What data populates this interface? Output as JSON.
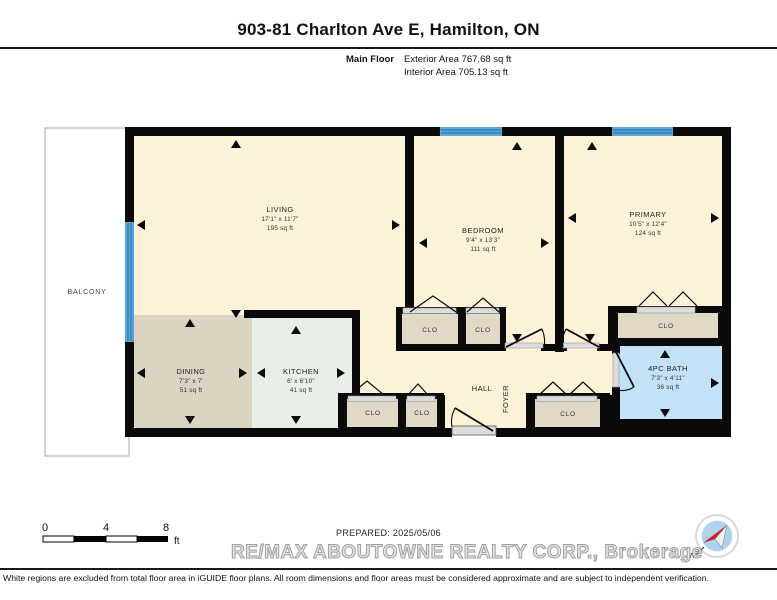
{
  "header": {
    "title": "903-81 Charlton Ave E, Hamilton, ON",
    "floor_label": "Main Floor",
    "exterior_area": "Exterior Area 767.68 sq ft",
    "interior_area": "Interior Area 705.13 sq ft"
  },
  "rooms": {
    "living": {
      "name": "LIVING",
      "dims": "17'1\" x 11'7\"",
      "area": "195 sq ft"
    },
    "bedroom": {
      "name": "BEDROOM",
      "dims": "9'4\" x 13'3\"",
      "area": "111 sq ft"
    },
    "primary": {
      "name": "PRIMARY",
      "dims": "10'5\" x 12'4\"",
      "area": "124 sq ft"
    },
    "dining": {
      "name": "DINING",
      "dims": "7'3\" x 7'",
      "area": "51 sq ft"
    },
    "kitchen": {
      "name": "KITCHEN",
      "dims": "6' x 6'10\"",
      "area": "41 sq ft"
    },
    "bath": {
      "name": "4PC BATH",
      "dims": "7'3\" x 4'11\"",
      "area": "36 sq ft"
    },
    "balcony": {
      "name": "BALCONY"
    },
    "hall": {
      "name": "HALL"
    },
    "foyer": {
      "name": "FOYER"
    },
    "closet": {
      "name": "CLO"
    }
  },
  "scale": {
    "ticks": [
      "0",
      "4",
      "8"
    ],
    "unit": "ft"
  },
  "footer": {
    "prepared": "PREPARED: 2025/05/06",
    "watermark": "RE/MAX ABOUTOWNE REALTY CORP., Brokerage",
    "disclaimer": "White regions are excluded from total floor area in iGUIDE floor plans. All room dimensions and floor areas must be considered approximate and are subject to independent verification.",
    "compass_north_label": "N"
  },
  "colors": {
    "wall": "#0a0a0a",
    "floor": "#FBF2D8",
    "dining_floor": "#DCD4C2",
    "kitchen_floor": "#E7EFE7",
    "bath_floor": "#C3E2F7",
    "closet_floor": "#E1D8C7",
    "window": "#57A7DC",
    "compass_red": "#CC2027"
  }
}
